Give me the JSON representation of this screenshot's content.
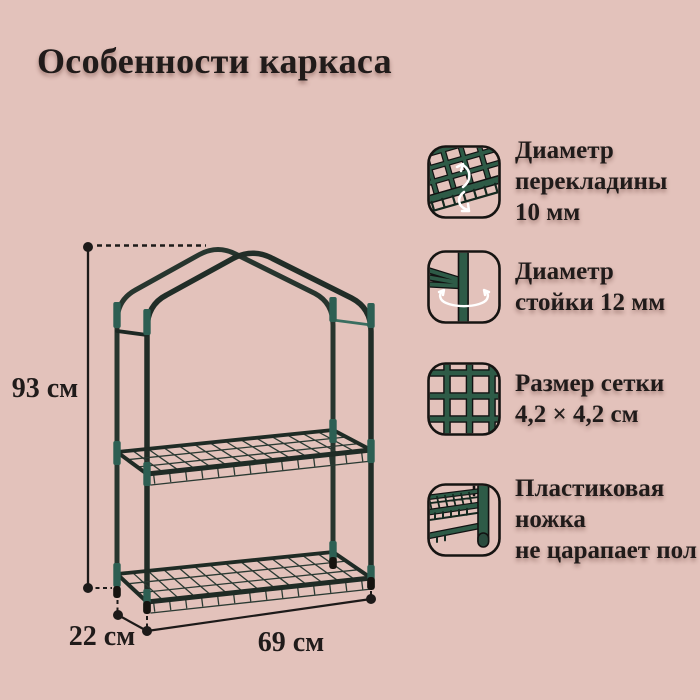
{
  "page": {
    "title": "Особенности каркаса",
    "background_color": "#e3c2bb",
    "text_color": "#201b1a"
  },
  "diagram": {
    "description": "two-tier greenhouse shelf frame with gabled top",
    "frame_color": "#212d27",
    "connector_color": "#2d5f53",
    "dim_height": "93 см",
    "dim_depth": "22 см",
    "dim_width": "69 см"
  },
  "features": [
    {
      "icon": "crossbar-diameter-icon",
      "lines": [
        "Диаметр",
        "перекладины",
        "10 мм"
      ]
    },
    {
      "icon": "post-diameter-icon",
      "lines": [
        "Диаметр",
        "стойки 12 мм"
      ]
    },
    {
      "icon": "mesh-size-icon",
      "lines": [
        "Размер сетки",
        "4,2 × 4,2 см"
      ]
    },
    {
      "icon": "plastic-foot-icon",
      "lines": [
        "Пластиковая",
        "ножка",
        "не царапает пол"
      ]
    }
  ],
  "accent_green": "#2e5b47"
}
